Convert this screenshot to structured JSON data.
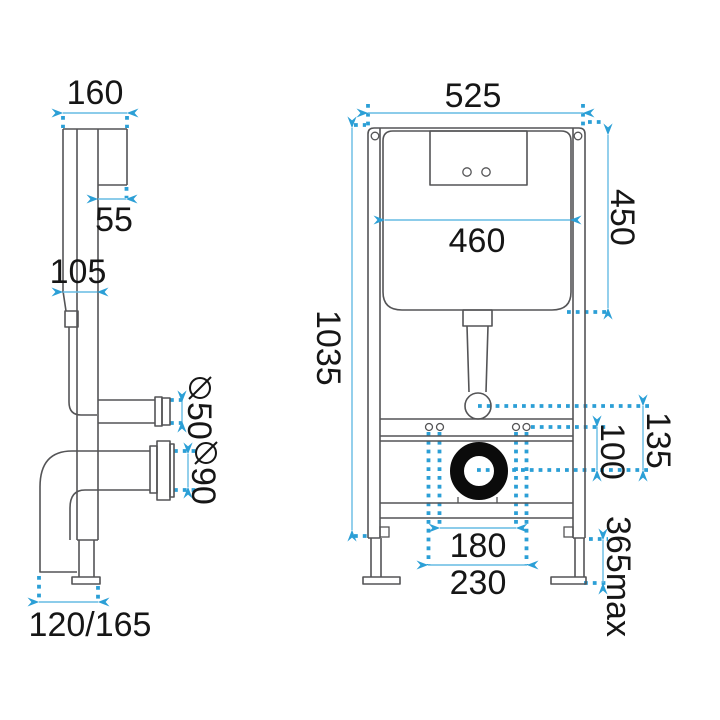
{
  "title": "concealed-wc-frame-technical-drawing",
  "colors": {
    "background": "#ffffff",
    "drawing_line": "#545456",
    "outlet_ring": "#0b0b0b",
    "dimension_accent": "#2b9fd6",
    "dimension_line": "#66bbe4",
    "text": "#161616"
  },
  "side_view": {
    "dimensions": {
      "total_depth": "160",
      "bracket_offset": "55",
      "cistern_depth": "105",
      "diameter_symbol": "⌀",
      "inlet_pipe_diameter": "50",
      "outlet_pipe_diameter": "90",
      "foot_adjust_range": "120/165"
    }
  },
  "front_view": {
    "dimensions": {
      "frame_width": "525",
      "frame_height": "1035",
      "cistern_width": "460",
      "cistern_height": "450",
      "flush_bend_offset": "135",
      "fixing_offset": "100",
      "fixing_spacing_inner": "180",
      "fixing_spacing_outer": "230",
      "leg_extension_max": "365max"
    }
  }
}
